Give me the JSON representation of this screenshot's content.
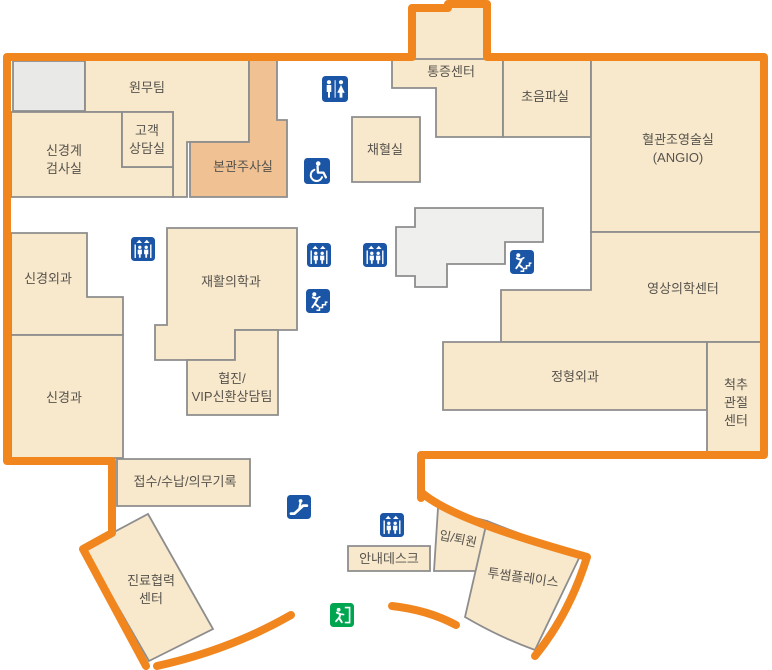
{
  "map_type": "hospital-floor-map",
  "rooms": {
    "admin_team": {
      "label": "원무팀"
    },
    "neuro_exam": {
      "lines": [
        "신경계",
        "검사실"
      ]
    },
    "customer_consult": {
      "lines": [
        "고객",
        "상담실"
      ]
    },
    "main_injection": {
      "label": "본관주사실",
      "highlighted": true
    },
    "blood_collection": {
      "label": "채혈실"
    },
    "pain_center": {
      "label": "통증센터"
    },
    "ultrasound": {
      "label": "초음파실"
    },
    "angio": {
      "lines": [
        "혈관조영술실",
        "(ANGIO)"
      ]
    },
    "imaging_center": {
      "label": "영상의학센터"
    },
    "orthopedics": {
      "label": "정형외과"
    },
    "spine_joint": {
      "lines": [
        "척추",
        "관절",
        "센터"
      ]
    },
    "neurosurgery": {
      "label": "신경외과"
    },
    "neurology": {
      "label": "신경과"
    },
    "rehab_medicine": {
      "label": "재활의학과"
    },
    "vip_consult": {
      "lines": [
        "협진/",
        "VIP신환상담팀"
      ]
    },
    "reception": {
      "label": "접수/수납/의무기록"
    },
    "referral_center": {
      "lines": [
        "진료협력",
        "센터"
      ]
    },
    "info_desk": {
      "label": "안내데스크"
    },
    "admission_discharge": {
      "label": "입/퇴원"
    },
    "twosome_place": {
      "label": "투썸플레이스"
    }
  },
  "icons": {
    "legend": {
      "restroom-icon": "man-and-woman-figures",
      "wheelchair-icon": "wheelchair-accessible-symbol",
      "elevator-icon": "two-people-with-up-arrows",
      "stairs-icon": "person-walking-on-steps",
      "escalator-icon": "person-on-escalator",
      "exit-icon": "running-person-through-exit-door"
    },
    "instances": [
      "restroom",
      "wheelchair",
      "elevator",
      "elevator",
      "elevator",
      "stairs",
      "stairs",
      "escalator",
      "elevator",
      "exit"
    ]
  },
  "colors": {
    "outline_orange": "#F1861F",
    "room_fill": "#F8E9CD",
    "highlight_room_fill": "#F0C193",
    "gray_room_fill": "#E9E9E8",
    "room_border": "#8D8D8D",
    "label_text": "#57534C",
    "icon_blue": "#1B55A5",
    "exit_green": "#00A550"
  }
}
